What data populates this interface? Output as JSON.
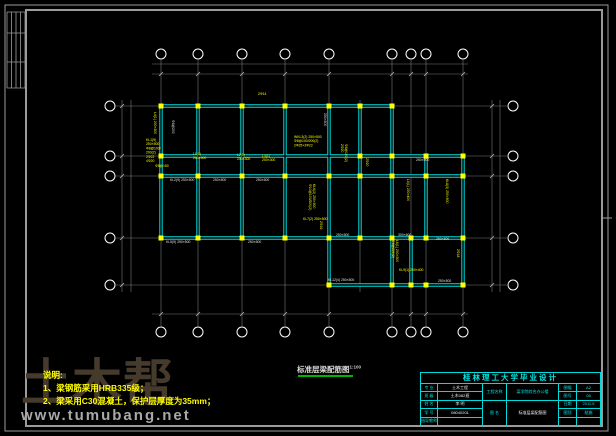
{
  "watermark": {
    "logo": "土木帮",
    "url": "www.tumubang.net"
  },
  "notes": {
    "title": "说明:",
    "lines": [
      "1、梁钢筋采用HRB335级；",
      "2、梁采用C30混凝土，保护层厚度为35mm；"
    ]
  },
  "caption": {
    "text": "标准层梁配筋图",
    "scale": "1:100"
  },
  "title_block": {
    "title": "桂林理工大学毕业设计",
    "left_rows": [
      {
        "label": "专 业",
        "value": "土木工程"
      },
      {
        "label": "班 级",
        "value": "土木082班"
      },
      {
        "label": "姓 名",
        "value": "李 明"
      },
      {
        "label": "学 号",
        "value": "08040201"
      },
      {
        "label": "指导教师",
        "value": ""
      }
    ],
    "project_label": "工程名称",
    "project_name": "某学院综合办公楼",
    "drawing_label": "图 名",
    "drawing_name": "标准层梁配筋图",
    "right_rows": [
      {
        "label": "图幅",
        "value": "A2"
      },
      {
        "label": "图号",
        "value": "08"
      },
      {
        "label": "日期",
        "value": "2011.6"
      },
      {
        "label": "图别",
        "value": "结施"
      },
      {
        "label": "",
        "value": ""
      }
    ]
  },
  "colors": {
    "bg": "#000000",
    "frame": "#9b9b9b",
    "grid": "#7a7a7a",
    "beam": "#00dcdc",
    "column": "#ffff00",
    "annotation": "#ffff00",
    "white_label": "#e2e2e2",
    "dim_text": "#b4b4b4",
    "bubble": "#ffffff",
    "underline": "#00b400"
  },
  "drawing": {
    "frame": {
      "outer": [
        5,
        5,
        603,
        426
      ],
      "inner": [
        26,
        10,
        576,
        416
      ],
      "corner_v": [
        7,
        11.5,
        16,
        20.5,
        25
      ],
      "corner_h": [
        12,
        33,
        62,
        88
      ],
      "right_mark": [
        602,
        218,
        612,
        218
      ]
    },
    "axes_x": [
      {
        "id": "1",
        "x": 161
      },
      {
        "id": "2",
        "x": 198
      },
      {
        "id": "3",
        "x": 242
      },
      {
        "id": "4",
        "x": 285
      },
      {
        "id": "5",
        "x": 329
      },
      {
        "id": "6",
        "x": 392
      },
      {
        "id": "7",
        "x": 411
      },
      {
        "id": "8",
        "x": 426
      },
      {
        "id": "9",
        "x": 463
      }
    ],
    "axes_y": [
      {
        "id": "E",
        "y": 106
      },
      {
        "id": "D",
        "y": 156
      },
      {
        "id": "C",
        "y": 176
      },
      {
        "id": "B",
        "y": 238
      },
      {
        "id": "A",
        "y": 285
      }
    ],
    "extra_grid": [
      [
        360,
        100,
        292
      ]
    ],
    "grid_span_v": [
      60,
      326
    ],
    "grid_span_h": [
      116,
      507
    ],
    "bubbles": {
      "top": 54,
      "bottom": 332,
      "left": 110,
      "right": 513,
      "r": 5
    },
    "dim_lines": [
      [
        152,
        64,
        468,
        64
      ],
      [
        152,
        74,
        468,
        74
      ],
      [
        152,
        314,
        468,
        314
      ],
      [
        122,
        100,
        122,
        292
      ],
      [
        131,
        100,
        131,
        292
      ],
      [
        492,
        100,
        492,
        292
      ],
      [
        500,
        100,
        500,
        292
      ]
    ],
    "tick_rows": [
      74,
      314
    ],
    "tick_cols": [
      122,
      492
    ],
    "dim_texts": [
      {
        "x": 179,
        "y": 71.8,
        "t": "3600"
      },
      {
        "x": 220,
        "y": 71.8,
        "t": "4200"
      },
      {
        "x": 263,
        "y": 71.8,
        "t": "4200"
      },
      {
        "x": 307,
        "y": 71.8,
        "t": "4200"
      },
      {
        "x": 360,
        "y": 71.8,
        "t": "6000"
      },
      {
        "x": 401,
        "y": 71.8,
        "t": "1800"
      },
      {
        "x": 418,
        "y": 71.8,
        "t": "1500"
      },
      {
        "x": 444,
        "y": 71.8,
        "t": "3600"
      },
      {
        "x": 312,
        "y": 61.8,
        "t": "29100"
      },
      {
        "x": 179,
        "y": 311.8,
        "t": "3600"
      },
      {
        "x": 220,
        "y": 311.8,
        "t": "4200"
      },
      {
        "x": 263,
        "y": 311.8,
        "t": "4200"
      },
      {
        "x": 307,
        "y": 311.8,
        "t": "4200"
      },
      {
        "x": 360,
        "y": 311.8,
        "t": "6000"
      },
      {
        "x": 401,
        "y": 311.8,
        "t": "1800"
      },
      {
        "x": 418,
        "y": 311.8,
        "t": "1500"
      },
      {
        "x": 444,
        "y": 311.8,
        "t": "3600"
      },
      {
        "x": 119.8,
        "y": 131,
        "t": "4800",
        "rot": -90
      },
      {
        "x": 119.8,
        "y": 166,
        "t": "2100",
        "rot": -90
      },
      {
        "x": 119.8,
        "y": 207,
        "t": "6000",
        "rot": -90
      },
      {
        "x": 119.8,
        "y": 261,
        "t": "4500",
        "rot": -90
      },
      {
        "x": 128.8,
        "y": 195,
        "t": "17400",
        "rot": -90
      },
      {
        "x": 489.8,
        "y": 131,
        "t": "4800",
        "rot": -90
      },
      {
        "x": 489.8,
        "y": 166,
        "t": "2100",
        "rot": -90
      },
      {
        "x": 489.8,
        "y": 207,
        "t": "6000",
        "rot": -90
      },
      {
        "x": 489.8,
        "y": 261,
        "t": "4500",
        "rot": -90
      },
      {
        "x": 497.8,
        "y": 195,
        "t": "17400",
        "rot": -90
      }
    ],
    "beams": [
      [
        161,
        106,
        392,
        106
      ],
      [
        161,
        156,
        463,
        156
      ],
      [
        161,
        176,
        463,
        176
      ],
      [
        161,
        238,
        463,
        238
      ],
      [
        329,
        285,
        463,
        285
      ],
      [
        161,
        106,
        161,
        238
      ],
      [
        198,
        106,
        198,
        238
      ],
      [
        242,
        106,
        242,
        238
      ],
      [
        285,
        106,
        285,
        238
      ],
      [
        329,
        106,
        329,
        285
      ],
      [
        360,
        106,
        360,
        238
      ],
      [
        392,
        106,
        392,
        285
      ],
      [
        411,
        238,
        411,
        285
      ],
      [
        426,
        156,
        426,
        238
      ],
      [
        463,
        156,
        463,
        285
      ]
    ],
    "columns": [
      [
        161,
        106
      ],
      [
        198,
        106
      ],
      [
        242,
        106
      ],
      [
        285,
        106
      ],
      [
        329,
        106
      ],
      [
        360,
        106
      ],
      [
        392,
        106
      ],
      [
        161,
        156
      ],
      [
        360,
        156
      ],
      [
        392,
        156
      ],
      [
        426,
        156
      ],
      [
        463,
        156
      ],
      [
        161,
        176
      ],
      [
        198,
        176
      ],
      [
        242,
        176
      ],
      [
        285,
        176
      ],
      [
        329,
        176
      ],
      [
        360,
        176
      ],
      [
        392,
        176
      ],
      [
        426,
        176
      ],
      [
        463,
        176
      ],
      [
        161,
        238
      ],
      [
        198,
        238
      ],
      [
        242,
        238
      ],
      [
        285,
        238
      ],
      [
        329,
        238
      ],
      [
        360,
        238
      ],
      [
        392,
        238
      ],
      [
        411,
        238
      ],
      [
        426,
        238
      ],
      [
        463,
        238
      ],
      [
        329,
        285
      ],
      [
        392,
        285
      ],
      [
        411,
        285
      ],
      [
        426,
        285
      ],
      [
        463,
        285
      ]
    ],
    "annotations": [
      {
        "x": 146,
        "y": 141,
        "lines": [
          "KL1(9)",
          "250×500",
          "Φ8@100/",
          "200(2)",
          "2Φ22",
          "4Φ20"
        ]
      },
      {
        "x": 154,
        "y": 112,
        "r": 90,
        "lines": [
          "L4(1) 200×300"
        ]
      },
      {
        "x": 155,
        "y": 167,
        "lines": [
          "Φ8@150"
        ]
      },
      {
        "x": 193,
        "y": 155,
        "lines": [
          "L1(1)",
          "200×300"
        ]
      },
      {
        "x": 237,
        "y": 156,
        "lines": [
          "L2(1)",
          "200×300"
        ]
      },
      {
        "x": 262,
        "y": 157,
        "lines": [
          "L3(1)",
          "200×300"
        ]
      },
      {
        "x": 258,
        "y": 95,
        "lines": [
          "2Φ14"
        ]
      },
      {
        "x": 294,
        "y": 138,
        "lines": [
          "WKL3(2) 250×500",
          "Φ8@100/200(2)",
          "2Φ25+2Φ22"
        ]
      },
      {
        "x": 345,
        "y": 144,
        "r": 90,
        "lines": [
          "Φ8@100(2)",
          "2Φ20"
        ]
      },
      {
        "x": 313,
        "y": 184,
        "r": 90,
        "lines": [
          "KL6(2) 250×500",
          "Φ10@100/200(2)"
        ]
      },
      {
        "x": 303,
        "y": 220,
        "lines": [
          "KL7(2) 250×500"
        ]
      },
      {
        "x": 407,
        "y": 179,
        "r": 90,
        "lines": [
          "L5(1) 200×400"
        ]
      },
      {
        "x": 446,
        "y": 179,
        "r": 90,
        "lines": [
          "KL8(3) 250×500"
        ]
      },
      {
        "x": 366,
        "y": 158,
        "r": 90,
        "lines": [
          "2Φ20"
        ]
      },
      {
        "x": 320,
        "y": 221,
        "r": 90,
        "lines": [
          "2Φ16"
        ]
      },
      {
        "x": 396,
        "y": 240,
        "r": 90,
        "lines": [
          "L6(1) 200×300",
          "Φ8@200(2)"
        ]
      },
      {
        "x": 399,
        "y": 271,
        "lines": [
          "KL9(1) 250×400"
        ]
      },
      {
        "x": 457,
        "y": 249,
        "r": 90,
        "lines": [
          "2Φ18"
        ]
      },
      {
        "x": 170,
        "y": 181,
        "c": "w",
        "lines": [
          "KL2(9) 250×500"
        ]
      },
      {
        "x": 213,
        "y": 181,
        "c": "w",
        "lines": [
          "250×500"
        ]
      },
      {
        "x": 256,
        "y": 181,
        "c": "w",
        "lines": [
          "250×500"
        ]
      },
      {
        "x": 416,
        "y": 161,
        "c": "w",
        "lines": [
          "250×500"
        ]
      },
      {
        "x": 166,
        "y": 243,
        "c": "w",
        "lines": [
          "KL5(9) 250×500"
        ]
      },
      {
        "x": 248,
        "y": 243,
        "c": "w",
        "lines": [
          "250×500"
        ]
      },
      {
        "x": 336,
        "y": 236,
        "c": "w",
        "lines": [
          "250×500"
        ]
      },
      {
        "x": 398,
        "y": 236,
        "c": "w",
        "lines": [
          "300×600"
        ]
      },
      {
        "x": 436,
        "y": 240,
        "c": "w",
        "lines": [
          "250×500"
        ]
      },
      {
        "x": 328,
        "y": 281,
        "c": "w",
        "lines": [
          "KL12(4) 250×500"
        ]
      },
      {
        "x": 438,
        "y": 282,
        "c": "w",
        "lines": [
          "250×500"
        ]
      },
      {
        "x": 324,
        "y": 113,
        "c": "w",
        "r": 90,
        "lines": [
          "250×500"
        ]
      },
      {
        "x": 172,
        "y": 120,
        "c": "w",
        "r": 90,
        "lines": [
          "Φ8@200"
        ]
      }
    ]
  }
}
